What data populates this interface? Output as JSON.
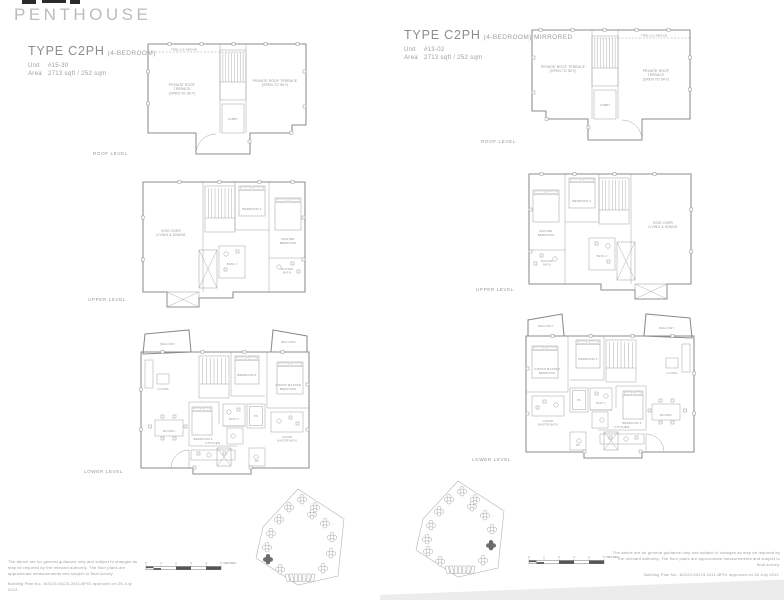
{
  "title": "PENTHOUSE",
  "units": {
    "left": {
      "type_name": "TYPE C2PH",
      "bedroom_suffix": "(4-BEDROOM)",
      "unit_label": "Unit",
      "unit_no": "#15-30",
      "area_label": "Area",
      "area_value": "2713 sqft / 252 sqm"
    },
    "right": {
      "type_name": "TYPE C2PH",
      "bedroom_suffix": "(4-BEDROOM) MIRRORED",
      "unit_label": "Unit",
      "unit_no": "#13-02",
      "area_label": "Area",
      "area_value": "2713 sqft / 252 sqm"
    }
  },
  "levels": {
    "roof": "ROOF LEVEL",
    "upper": "UPPER LEVEL",
    "lower": "LOWER LEVEL"
  },
  "rooms": {
    "roof": {
      "trellis": "TRELLIS ABOVE",
      "terrace_left": [
        "PRIVATE ROOF",
        "TERRACE",
        "(OPEN TO SKY)"
      ],
      "terrace_right": [
        "PRIVATE ROOF TERRACE",
        "(OPEN TO SKY)"
      ],
      "lobby": "LOBBY"
    },
    "upper": {
      "void_area": [
        "VOID OVER",
        "LIVING & DINING"
      ],
      "bedroom4": "BEDROOM 4",
      "master_bedroom": [
        "MASTER",
        "BEDROOM"
      ],
      "bath4": "BATH 4",
      "master_bath": [
        "MASTER",
        "BATH"
      ]
    },
    "lower": {
      "balcony_left": "BALCONY",
      "balcony_right": "BALCONY",
      "living": "LIVING",
      "dining": "DINING",
      "kitchen": "KITCHEN",
      "bedroom2": "BEDROOM 2",
      "bedroom3": "BEDROOM 3",
      "junior_master": [
        "JUNIOR MASTER",
        "BEDROOM"
      ],
      "junior_bath": [
        "JUNIOR",
        "MASTER BATH"
      ],
      "bath2": "BATH 2",
      "wc": "WC",
      "hs": "HS"
    }
  },
  "scalebar": {
    "ticks": [
      "0",
      "1",
      "2",
      "3",
      "4",
      "5"
    ],
    "unit": "METRES"
  },
  "disclaimer": {
    "line1": "The above are for general guidance only and subject to changes as may be required by the relevant authority. The floor plans are approximate measurements and subject to final survey.",
    "line2": "Building Plan No.: A0123-00123-2011-BP01 approved on 26 July 2012."
  },
  "colors": {
    "line": "#9a9a9a",
    "wall": "#8c8c8c",
    "text": "#8f8f8f",
    "title": "#bcbcbc",
    "highlight": "#6f6f6f"
  }
}
